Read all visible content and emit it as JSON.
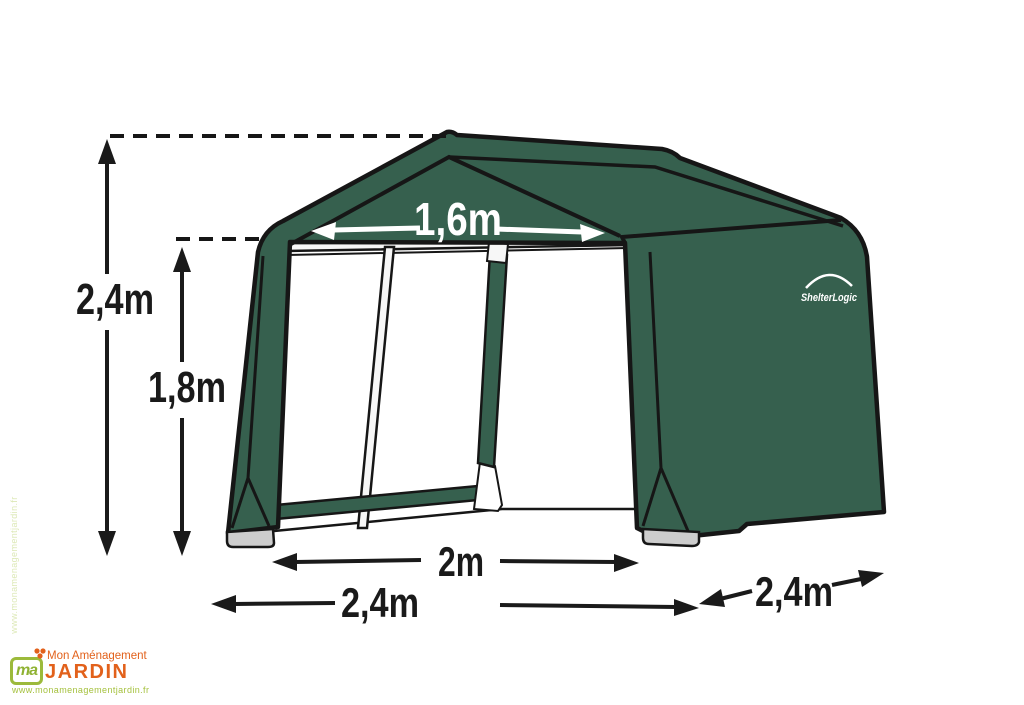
{
  "shelter": {
    "brand": "ShelterLogic",
    "colors": {
      "canvas_green": "#36604E",
      "outline": "#161616",
      "foot_grey": "#cdcdcd",
      "frame_white": "#f7f7f7"
    }
  },
  "dimensions": {
    "total_height": "2,4m",
    "door_height": "1,8m",
    "door_width": "1,6m",
    "inner_width": "2m",
    "front_width": "2,4m",
    "depth": "2,4m"
  },
  "watermark": {
    "monogram": "ma",
    "name_top": "Mon Aménagement",
    "name_bottom": "JARDIN",
    "website": "www.monamenagementjardin.fr",
    "colors": {
      "orange": "#e2611b",
      "green": "#9cba3b",
      "light_green": "#a5c13e"
    }
  }
}
